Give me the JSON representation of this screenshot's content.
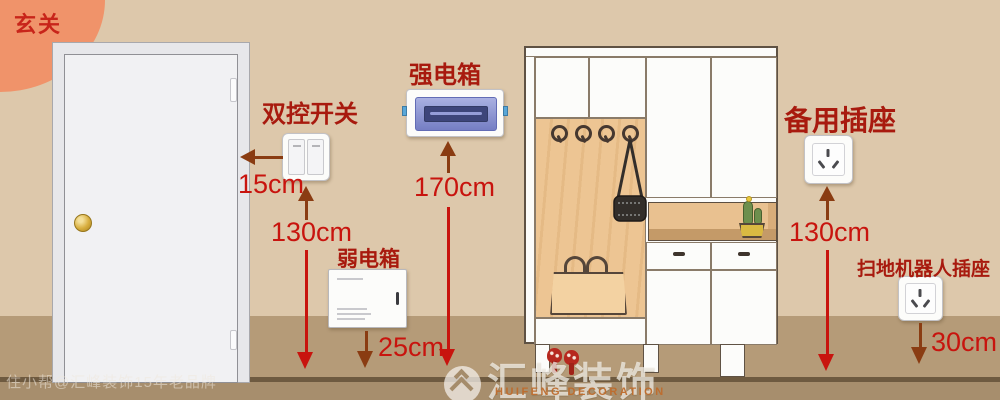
{
  "badge": {
    "label": "玄关"
  },
  "annotations": {
    "switch": {
      "label": "双控开关",
      "offset": "15cm",
      "height": "130cm"
    },
    "strong_box": {
      "label": "强电箱",
      "height": "170cm"
    },
    "weak_box": {
      "label": "弱电箱",
      "height": "25cm"
    },
    "spare_socket": {
      "label": "备用插座",
      "height": "130cm"
    },
    "robot_socket": {
      "label": "扫地机器人插座",
      "height": "30cm"
    }
  },
  "watermark": {
    "brand": "汇峰装饰",
    "brand_en": "HUIFENG DECORATION",
    "credit": "住小帮@汇峰装饰15年老品牌"
  },
  "icons": {
    "logo": "mountain-double-chevron-circle",
    "coat_hook": "spiral-hook",
    "handbag": "black-shoulder-bag",
    "tote": "tan-tote-bag",
    "plant": "potted-cactus",
    "heels": "red-heeled-slippers",
    "doorknob": "round-gold-knob"
  },
  "colors": {
    "wall": "#ddc8ab",
    "floor": "#b59b78",
    "floor_line": "#6e5a40",
    "floor_lower": "#a78e6d",
    "badge": "#f0936a",
    "label_red": "#a81a0e",
    "measure_red": "#c8140e",
    "arrow_brown": "#8a3c12",
    "wood": "#edc593",
    "strongbox_window": "#6a74c0"
  }
}
